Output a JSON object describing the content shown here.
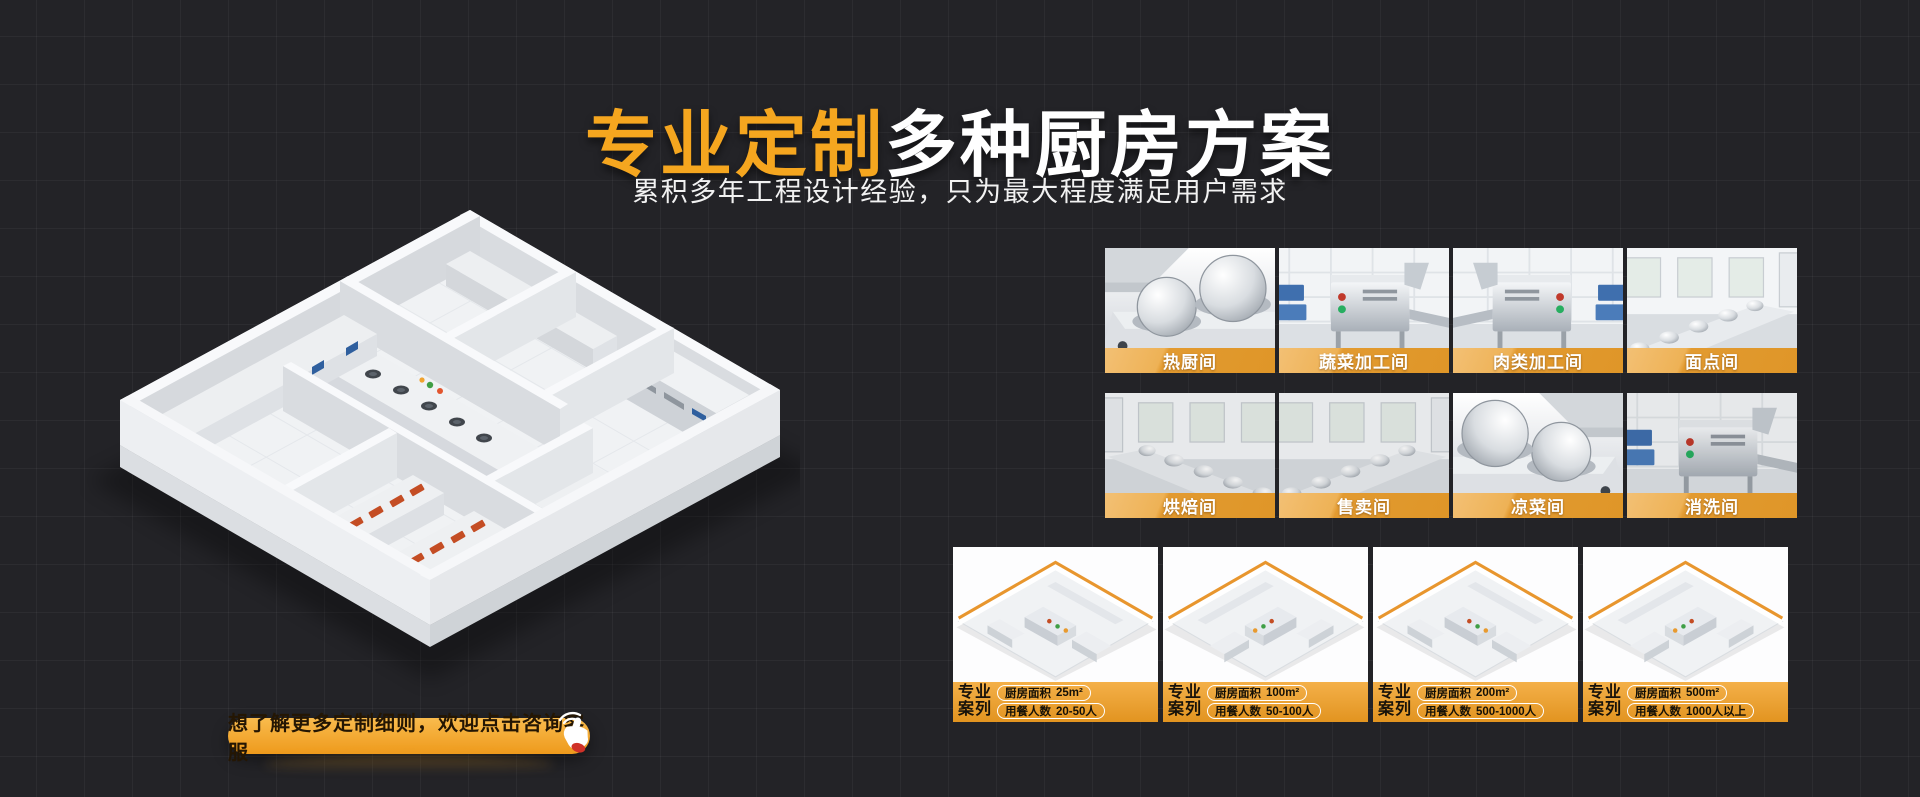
{
  "hero": {
    "title_accent": "专业定制",
    "title_main": "多种厨房方案",
    "subtitle": "累积多年工程设计经验，只为最大程度满足用户需求"
  },
  "cta": {
    "label": "想了解更多定制细则，欢迎点击咨询客服"
  },
  "icons": {
    "cta_hand": "click-hand-icon",
    "left_illustration": "isometric-kitchen-floorplan",
    "tile_photos": [
      "hot-kitchen-photo",
      "vegetable-processing-photo",
      "meat-processing-photo",
      "pastry-room-photo",
      "baking-room-photo",
      "serving-room-photo",
      "cold-dish-room-photo",
      "dishwashing-room-photo"
    ]
  },
  "colors": {
    "background": "#232327",
    "accent_orange": "#F5A61F",
    "band_orange_light": "#F0B95F",
    "band_orange_dark": "#E0951F"
  },
  "rooms": [
    {
      "label": "热厨间"
    },
    {
      "label": "蔬菜加工间"
    },
    {
      "label": "肉类加工间"
    },
    {
      "label": "面点间"
    },
    {
      "label": "烘焙间"
    },
    {
      "label": "售卖间"
    },
    {
      "label": "凉菜间"
    },
    {
      "label": "消洗间"
    }
  ],
  "cases": [
    {
      "tag_top": "专业",
      "tag_bottom": "案列",
      "rows": [
        {
          "label": "厨房面积",
          "value": "25m²"
        },
        {
          "label": "用餐人数",
          "value": "20-50人"
        }
      ]
    },
    {
      "tag_top": "专业",
      "tag_bottom": "案列",
      "rows": [
        {
          "label": "厨房面积",
          "value": "100m²"
        },
        {
          "label": "用餐人数",
          "value": "50-100人"
        }
      ]
    },
    {
      "tag_top": "专业",
      "tag_bottom": "案列",
      "rows": [
        {
          "label": "厨房面积",
          "value": "200m²"
        },
        {
          "label": "用餐人数",
          "value": "500-1000人"
        }
      ]
    },
    {
      "tag_top": "专业",
      "tag_bottom": "案列",
      "rows": [
        {
          "label": "厨房面积",
          "value": "500m²"
        },
        {
          "label": "用餐人数",
          "value": "1000人以上"
        }
      ]
    }
  ]
}
